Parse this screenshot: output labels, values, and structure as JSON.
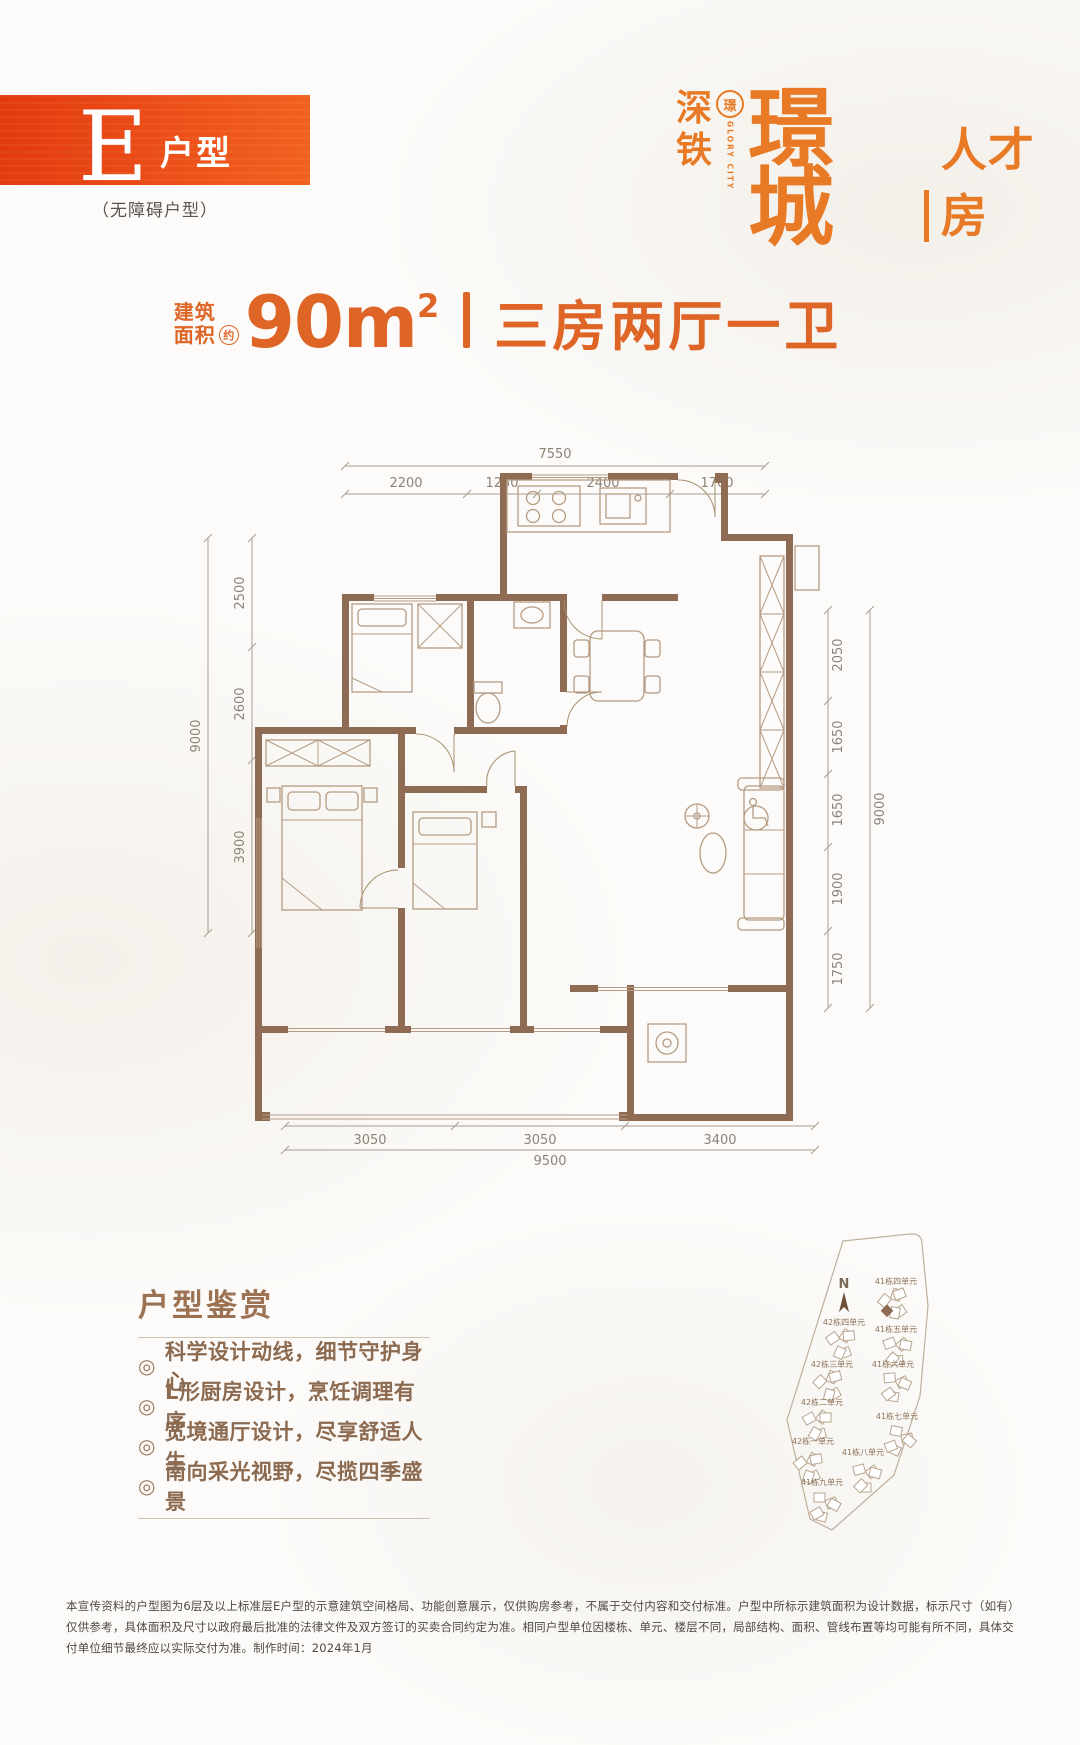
{
  "badge": {
    "letter": "E",
    "type_label": "户型",
    "subtitle": "（无障碍户型）"
  },
  "logo": {
    "shen": "深",
    "tie": "铁",
    "seal_char": "璟",
    "glory": "GLORY CITY",
    "name": "璟城",
    "suffix": "人才房"
  },
  "headline": {
    "prefix_top": "建筑",
    "prefix_bottom": "面积",
    "approx": "约",
    "area": "90m",
    "area_sup": "2",
    "rooms": "三房两厅一卫"
  },
  "floorplan": {
    "dims": {
      "top_total": "7550",
      "top_segments": [
        "2200",
        "1250",
        "2400",
        "1700"
      ],
      "left_total": "9000",
      "left_segments": [
        "2500",
        "2600",
        "3900"
      ],
      "right_segments": [
        "2050",
        "1650",
        "1650",
        "1900",
        "1750"
      ],
      "right_total": "9000",
      "bottom_segments": [
        "3050",
        "3050",
        "3400"
      ],
      "bottom_total": "9500"
    }
  },
  "features": {
    "title": "户型鉴赏",
    "bullet": "◎",
    "items": [
      "科学设计动线，细节守护身心",
      "L形厨房设计，烹饪调理有序",
      "宽境通厅设计，尽享舒适人生",
      "南向采光视野，尽揽四季盛景"
    ]
  },
  "sitemap": {
    "north": "N",
    "buildings": [
      "41栋四单元",
      "42栋四单元",
      "41栋五单元",
      "42栋三单元",
      "41栋六单元",
      "42栋二单元",
      "41栋七单元",
      "42栋一单元",
      "41栋八单元",
      "41栋九单元"
    ]
  },
  "disclaimer": {
    "text": "本宣传资料的户型图为6层及以上标准层E户型的示意建筑空间格局、功能创意展示，仅供购房参考，不属于交付内容和交付标准。户型中所标示建筑面积为设计数据，标示尺寸（如有）仅供参考，具体面积及尺寸以政府最后批准的法律文件及双方签订的买卖合同约定为准。相同户型单位因楼栋、单元、楼层不同，局部结构、面积、管线布置等均可能有所不同，具体交付单位细节最终应以实际交付为准。制作时间：2024年1月"
  },
  "colors": {
    "accent_orange": "#de6526",
    "logo_orange": "#e87a26",
    "badge_gradient_start": "#e23a0e",
    "badge_gradient_end": "#f2611f",
    "wall_brown": "#8f6b54",
    "dim_line": "#a89e90",
    "dim_text": "#8d8478",
    "furniture_line": "#b59b83",
    "feature_text": "#8c6a50",
    "map_line": "#bfaf9c",
    "disclaimer_text": "#4e4943"
  }
}
